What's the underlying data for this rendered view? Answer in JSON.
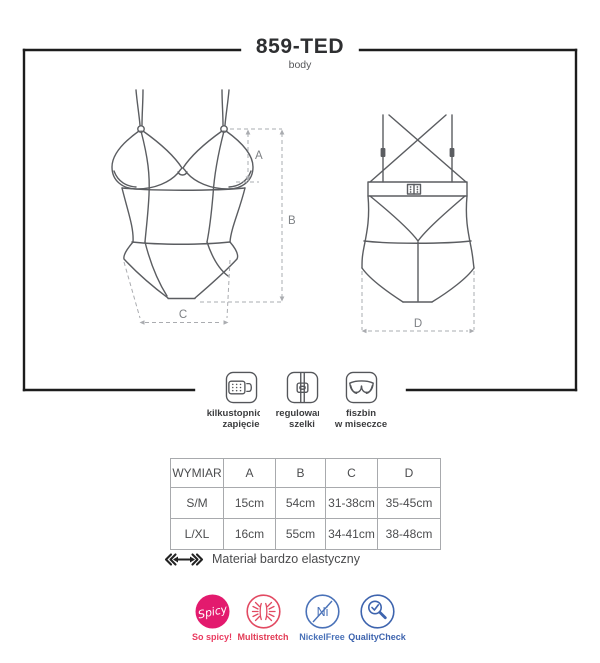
{
  "header": {
    "title": "859-TED",
    "subtitle": "body"
  },
  "diagram": {
    "dim_labels": {
      "a": "A",
      "b": "B",
      "c": "C",
      "d": "D"
    }
  },
  "features": [
    {
      "id": "multi-step-closure",
      "label_line1": "kilkustopniowe",
      "label_line2": "zapięcie"
    },
    {
      "id": "adjustable-straps",
      "label_line1": "regulowane",
      "label_line2": "szelki"
    },
    {
      "id": "underwired-cup",
      "label_line1": "fiszbin",
      "label_line2": "w miseczce"
    }
  ],
  "size_table": {
    "headers": [
      "WYMIAR",
      "A",
      "B",
      "C",
      "D"
    ],
    "rows": [
      [
        "S/M",
        "15cm",
        "54cm",
        "31-38cm",
        "35-45cm"
      ],
      [
        "L/XL",
        "16cm",
        "55cm",
        "34-41cm",
        "38-48cm"
      ]
    ]
  },
  "material_note": {
    "text": "Materiał bardzo elastyczny"
  },
  "badges": {
    "spicy": {
      "circle_text": "Spicy",
      "label": "So spicy!",
      "circle_color": "#e31a6e",
      "label_color": "#ea3a60"
    },
    "multistretch": {
      "label": "Multistretch",
      "color": "#e24a62",
      "label_color": "#e23b55"
    },
    "nickelfree": {
      "symbol": "Ni",
      "label": "NickelFree",
      "color": "#4a72b8"
    },
    "qualitycheck": {
      "label": "QualityCheck",
      "color": "#3e64ae"
    }
  }
}
